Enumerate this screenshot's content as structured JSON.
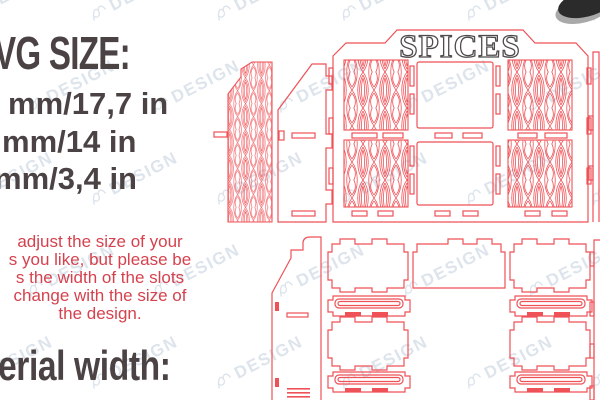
{
  "colors": {
    "background": "#ffffff",
    "heading_text": "#4a4243",
    "note_text": "#d5424e",
    "cut_line": "#ee5257",
    "watermark": "#c3cfdd",
    "spices_outline": "#4f4b4b",
    "photo_fragment_dark": "#2b2b2b",
    "photo_fragment_light": "#a9a9a9"
  },
  "info": {
    "size_heading": "VG SIZE:",
    "size_lines": [
      "mm/17,7 in",
      "mm/14 in",
      "mm/3,4 in"
    ],
    "note_lines": [
      "adjust the size of your",
      "s you like, but please be",
      "s the width of the slots",
      "change with the size of",
      "the design."
    ],
    "material_heading": "erial width:"
  },
  "cut_sheet": {
    "panel_title": "SPICES"
  },
  "watermark": {
    "logo": "script-flourish",
    "label": "DESIGN"
  }
}
